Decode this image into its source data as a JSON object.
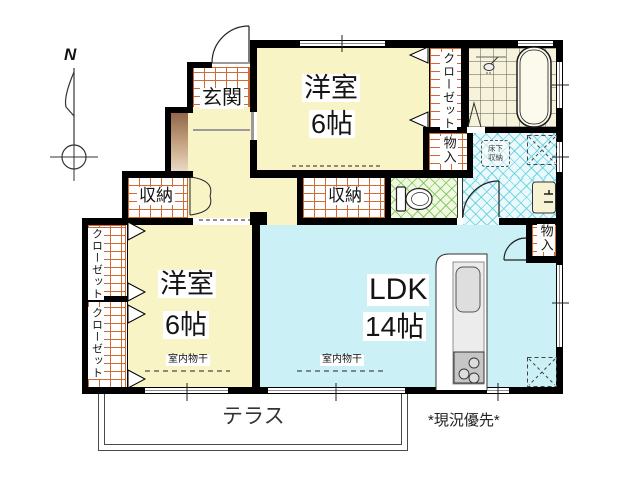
{
  "compass": {
    "north": "N"
  },
  "rooms": {
    "genkan": {
      "label": "玄関"
    },
    "bedroom_top": {
      "label": "洋室",
      "size": "6帖"
    },
    "bedroom_left": {
      "label": "洋室",
      "size": "6帖"
    },
    "ldk": {
      "label": "LDK",
      "size": "14帖"
    },
    "closet_top": {
      "label": "クローゼット"
    },
    "closet_left_upper": {
      "label": "クローゼット"
    },
    "closet_left_lower": {
      "label": "クローゼット"
    },
    "storage_hall": {
      "label": "収納"
    },
    "storage_mid": {
      "label": "収納"
    },
    "storage_bath_side": {
      "label": "物入"
    },
    "storage_ldk": {
      "label": "物入"
    },
    "underfloor_storage": {
      "line1": "床下",
      "line2": "収納"
    },
    "terrace": {
      "label": "テラス"
    }
  },
  "annotations": {
    "laundry_bedroom": "室内物干",
    "laundry_ldk": "室内物干",
    "note": "*現況優先*"
  },
  "colors": {
    "room_floor": "#F9F4C6",
    "ldk_floor": "#CBF0F6",
    "tile_line": "#CF6A35",
    "toilet_lattice": "#7DC35F",
    "washroom_lattice": "#5ACDDC",
    "wall": "#000000",
    "window_glass": "#8E8E8E",
    "entry_step_wood": "#8A5F41"
  }
}
